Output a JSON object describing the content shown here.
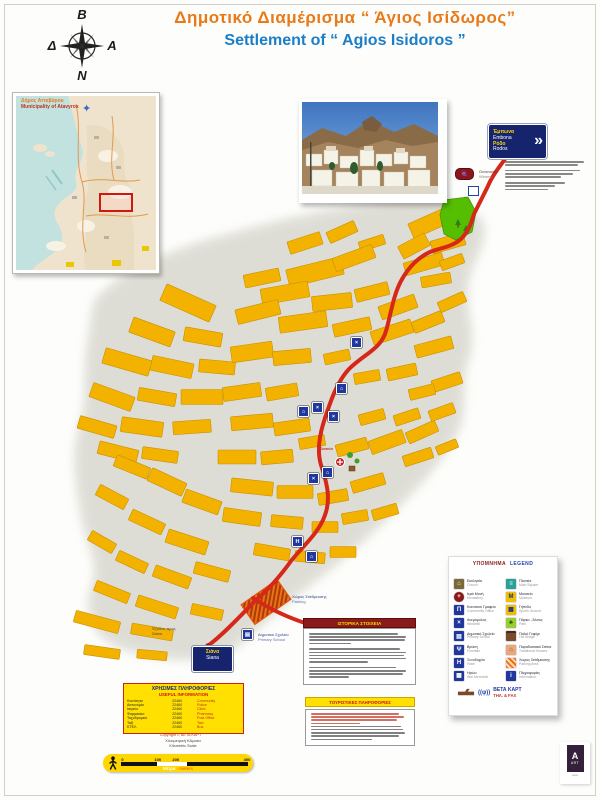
{
  "header": {
    "title_gr": "Δημοτικό Διαμέρισμα  “ Άγιος  Ισίδωρος”",
    "title_en": "Settlement of  “ Agios Isidoros ”"
  },
  "compass": {
    "n": "Β",
    "e": "Α",
    "s": "Ν",
    "w": "Δ"
  },
  "inset": {
    "title_gr": "Δήμος Ατταβύρου",
    "title_en": "Municipality of Atavyros"
  },
  "sign_top": {
    "lines": [
      "Έμπωνα",
      "Embona",
      "Ρόδο",
      "Rodos"
    ],
    "arrow": "»"
  },
  "winery": {
    "gr": "Οινοποιείο",
    "en": "Winery"
  },
  "parking": {
    "gr": "Χώρος Στάθμευσης",
    "en": "Parking"
  },
  "school": {
    "gr": "Δημοτικό Σχολείο",
    "en": "Primary School"
  },
  "plateia": "Πλατεία",
  "exit_note": {
    "l1": "Έξοδος προς",
    "l2": "Σιάνα"
  },
  "taxi_sign": {
    "l1": "Σιάνα",
    "l2": "Siana"
  },
  "legend": {
    "title_gr": "ΥΠΟΜΝΗΜΑ",
    "title_en": "LEGEND",
    "left": [
      [
        "Εκκλησία",
        "Church"
      ],
      [
        "Ιερά Μονή",
        "Monastery"
      ],
      [
        "Κοινοτικό Γραφείο",
        "Community Office"
      ],
      [
        "Ανεμόμυλος",
        "Windmill"
      ],
      [
        "Δημοτικό Σχολείο",
        "Primary School"
      ],
      [
        "Βρύση",
        "Fountain"
      ],
      [
        "Ξενοδοχείο",
        "Hotel"
      ],
      [
        "Ηρώο",
        "War Memorial"
      ]
    ],
    "right": [
      [
        "Πλατεία",
        "Main Square"
      ],
      [
        "Μουσείο",
        "Museum"
      ],
      [
        "Γήπεδο",
        "Sports Ground"
      ],
      [
        "Πάρκο - Άλσος",
        "Park"
      ],
      [
        "Παλιό Γεφύρι",
        "Old Bridge"
      ],
      [
        "Παραδοσιακά Σπίτια",
        "Traditional Houses"
      ],
      [
        "Χώρος Στάθμευσης",
        "Parking Area"
      ],
      [
        "Πληροφορίες",
        "Information"
      ]
    ]
  },
  "logo": {
    "name": "ΒΕΤΑ ΚΑΡΤ",
    "phone": "ΤΗΛ. & FAX",
    "phi": "((φ))"
  },
  "info_box": {
    "title_gr": "ΧΡΗΣΙΜΕΣ ΠΛΗΡΟΦΟΡΙΕΣ",
    "title_en": "USEFUL INFORMATION",
    "rows": [
      [
        "Κοινότητα",
        "22460",
        "Community"
      ],
      [
        "Αστυνομία",
        "22460",
        "Police"
      ],
      [
        "Ιατρείο",
        "22460",
        "Clinic"
      ],
      [
        "Φαρμακείο",
        "22460",
        "Pharmacy"
      ],
      [
        "Ταχυδρομείο",
        "22460",
        "Post Office"
      ],
      [
        "Ταξί",
        "22460",
        "Taxi"
      ],
      [
        "ΚΤΕΛ",
        "22460",
        "Bus"
      ]
    ]
  },
  "copyright": "Copyright © ΒΕΤΑ ΚΑΡΤ",
  "scale": {
    "t1": "Χιλιομετρική Κλίμακα",
    "t2": "Kilometric Scale",
    "labels": [
      "0",
      "100",
      "200",
      "400"
    ],
    "m_gr": "Μέτρα",
    "m_en": "- meters"
  },
  "boxes": {
    "history_title": "ΙΣΤΟΡΙΚΑ ΣΤΟΙΧΕΙΑ",
    "notes_title": "ΤΟΥΡΙΣΤΙΚΕΣ ΠΛΗΡΟΦΟΡΙΕΣ"
  },
  "badge": {
    "letter": "A",
    "caption": "ART"
  },
  "colors": {
    "accent_red": "#D6281A",
    "block_yellow": "#F3B200",
    "title_orange": "#E87A18",
    "title_blue": "#1B7EC8",
    "navy": "#20379E"
  }
}
